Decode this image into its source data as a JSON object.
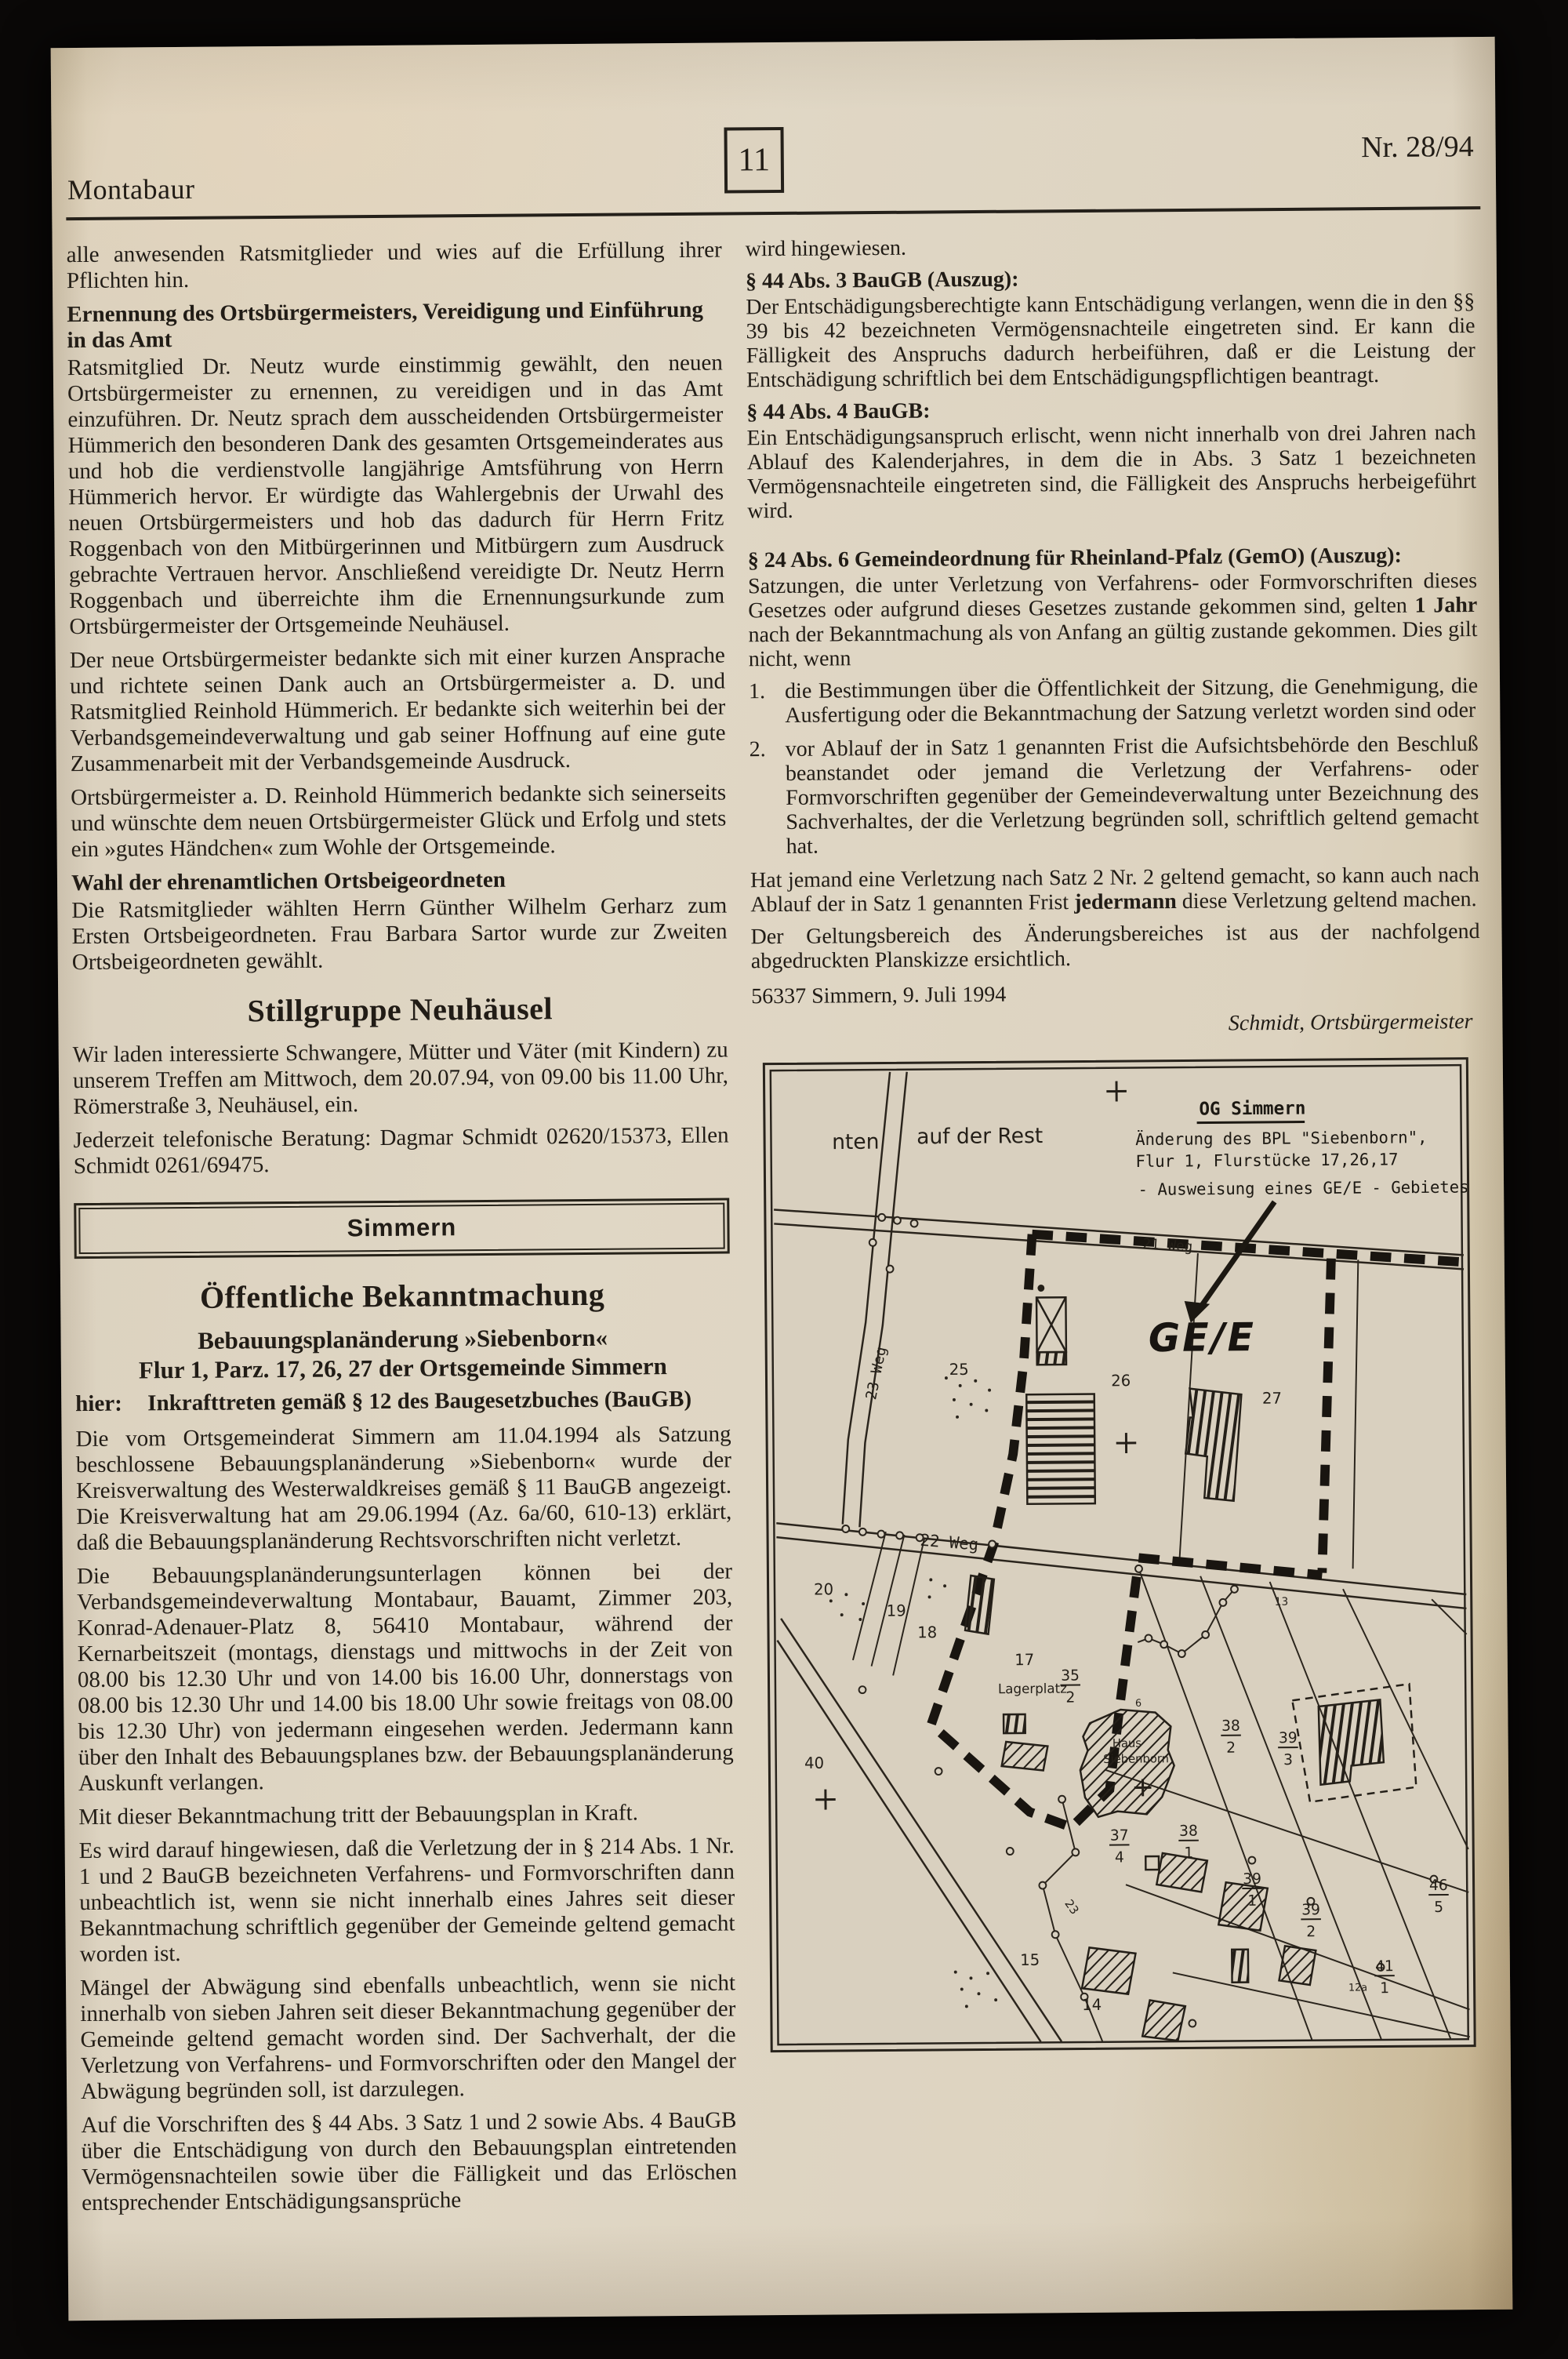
{
  "colors": {
    "paper": "#ddd3c0",
    "ink": "#211c16",
    "background": "#0a0807"
  },
  "header": {
    "title_left": "Montabaur",
    "page_number": "11",
    "issue": "Nr. 28/94"
  },
  "left": {
    "p1": "alle anwesenden Ratsmitglieder und wies auf die Erfüllung ihrer Pflichten hin.",
    "h1": "Ernennung des Ortsbürgermeisters, Vereidigung und Einführung in das Amt",
    "p2": "Ratsmitglied Dr. Neutz wurde einstimmig gewählt, den neuen Ortsbürgermeister zu ernennen, zu vereidigen und in das Amt einzuführen. Dr. Neutz sprach dem ausscheidenden Ortsbürgermeister Hümmerich den besonderen Dank des gesamten Ortsgemeinderates aus und hob die verdienstvolle langjährige Amtsführung von Herrn Hümmerich hervor. Er würdigte das Wahlergebnis der Urwahl des neuen Ortsbürgermeisters und hob das dadurch für Herrn Fritz Roggenbach von den Mitbürgerinnen und Mitbürgern zum Ausdruck gebrachte Vertrauen hervor. Anschließend vereidigte Dr. Neutz Herrn Roggenbach und überreichte ihm die Ernennungsurkunde zum Ortsbürgermeister der Ortsgemeinde Neuhäusel.",
    "p3": "Der neue Ortsbürgermeister bedankte sich mit einer kurzen Ansprache und richtete seinen Dank auch an Ortsbürgermeister a. D. und Ratsmitglied Reinhold Hümmerich. Er bedankte sich weiterhin bei der Verbandsgemeindeverwaltung und gab seiner Hoffnung auf eine gute Zusammenarbeit mit der Verbandsgemeinde Ausdruck.",
    "p4": "Ortsbürgermeister a. D. Reinhold Hümmerich bedankte sich seinerseits und wünschte dem neuen Ortsbürgermeister Glück und Erfolg und stets ein »gutes Händchen« zum Wohle der Ortsgemeinde.",
    "h2": "Wahl der ehrenamtlichen Ortsbeigeordneten",
    "p5": "Die Ratsmitglieder wählten Herrn Günther Wilhelm Gerharz zum Ersten Ortsbeigeordneten. Frau Barbara Sartor wurde zur Zweiten Ortsbeigeordneten gewählt.",
    "headline1": "Stillgruppe Neuhäusel",
    "p6": "Wir laden interessierte Schwangere, Mütter und Väter (mit Kindern) zu unserem Treffen am Mittwoch, dem 20.07.94, von 09.00 bis 11.00 Uhr, Römerstraße 3, Neuhäusel, ein.",
    "p7": "Jederzeit telefonische Beratung: Dagmar Schmidt 02620/15373, Ellen Schmidt 0261/69475.",
    "box_label": "Simmern",
    "headline2": "Öffentliche Bekanntmachung",
    "sub1": "Bebauungsplanänderung »Siebenborn«",
    "sub2": "Flur 1, Parz. 17, 26, 27 der Ortsgemeinde Simmern",
    "hier_label": "hier:",
    "hier_text": "Inkrafttreten gemäß § 12 des Baugesetzbuches (BauGB)",
    "p8": "Die vom Ortsgemeinderat Simmern am 11.04.1994 als Satzung beschlossene Bebauungsplanänderung »Siebenborn« wurde der Kreisverwaltung des Westerwaldkreises gemäß § 11 BauGB angezeigt. Die Kreisverwaltung hat am 29.06.1994 (Az. 6a/60, 610-13) erklärt, daß die Bebauungsplanänderung Rechtsvorschriften nicht verletzt.",
    "p9": "Die Bebauungsplanänderungsunterlagen können bei der Verbandsgemeindeverwaltung Montabaur, Bauamt, Zimmer 203, Konrad-Adenauer-Platz 8, 56410 Montabaur, während der Kernarbeitszeit (montags, dienstags und mittwochs in der Zeit von 08.00 bis 12.30 Uhr und von 14.00 bis 16.00 Uhr, donnerstags von 08.00 bis 12.30 Uhr und 14.00 bis 18.00 Uhr sowie freitags von 08.00 bis 12.30 Uhr) von jedermann eingesehen werden. Jedermann kann über den Inhalt des Bebauungsplanes bzw. der Bebauungsplanänderung Auskunft verlangen.",
    "p10": "Mit dieser Bekanntmachung tritt der Bebauungsplan in Kraft.",
    "p11": "Es wird darauf hingewiesen, daß die Verletzung der in § 214 Abs. 1 Nr. 1 und 2 BauGB bezeichneten Verfahrens- und Formvorschriften dann unbeachtlich ist, wenn sie nicht innerhalb eines Jahres seit dieser Bekanntmachung schriftlich gegenüber der Gemeinde geltend gemacht worden ist.",
    "p12": "Mängel der Abwägung sind ebenfalls unbeachtlich, wenn sie nicht innerhalb von sieben Jahren seit dieser Bekanntmachung gegenüber der Gemeinde geltend gemacht worden sind. Der Sachverhalt, der die Verletzung von Verfahrens- und Formvorschriften oder den Mangel der Abwägung begründen soll, ist darzulegen.",
    "p13": "Auf die Vorschriften des § 44 Abs. 3 Satz 1 und 2 sowie Abs. 4 BauGB über die Entschädigung von durch den Bebauungsplan eintretenden Vermögensnachteilen sowie über die Fälligkeit und das Erlöschen entsprechender Entschädigungsansprüche"
  },
  "right": {
    "p1": "wird hingewiesen.",
    "h1": "§ 44 Abs. 3 BauGB (Auszug):",
    "p2": "Der Entschädigungsberechtigte kann Entschädigung verlangen, wenn die in den §§ 39 bis 42 bezeichneten Vermögensnachteile eingetreten sind. Er kann die Fälligkeit des Anspruchs dadurch herbeiführen, daß er die Leistung der Entschädigung schriftlich bei dem Entschädigungspflichtigen beantragt.",
    "h2": "§ 44 Abs. 4 BauGB:",
    "p3": "Ein Entschädigungsanspruch erlischt, wenn nicht innerhalb von drei Jahren nach Ablauf des Kalenderjahres, in dem die in Abs. 3 Satz 1 bezeichneten Vermögensnachteile eingetreten sind, die Fälligkeit des Anspruchs herbeigeführt wird.",
    "h3": "§ 24 Abs. 6 Gemeindeordnung für Rheinland-Pfalz (GemO) (Auszug):",
    "p4a": "Satzungen, die unter Verletzung von Verfahrens- oder Formvorschriften dieses Gesetzes oder aufgrund dieses Gesetzes zustande gekommen sind, gelten ",
    "p4b": "1 Jahr",
    "p4c": " nach der Bekanntmachung als von Anfang an gültig zustande gekommen. Dies gilt nicht, wenn",
    "li1_num": "1.",
    "li1": "die Bestimmungen über die Öffentlichkeit der Sitzung, die Genehmigung, die Ausfertigung oder die Bekanntmachung der Satzung verletzt worden sind oder",
    "li2_num": "2.",
    "li2": "vor Ablauf der in Satz 1 genannten Frist die Aufsichtsbehörde den Beschluß beanstandet oder jemand die Verletzung der Verfahrens- oder Formvorschriften gegenüber der Gemeindeverwaltung unter Bezeichnung des Sachverhaltes, der die Verletzung begründen soll, schriftlich geltend gemacht hat.",
    "p5a": "Hat jemand eine Verletzung nach Satz 2 Nr. 2 geltend gemacht, so kann auch nach Ablauf der in Satz 1 genannten Frist ",
    "p5b": "jedermann",
    "p5c": " diese Verletzung geltend machen.",
    "p6": "Der Geltungsbereich des Änderungsbereiches ist aus der nachfolgend abgedruckten Planskizze ersichtlich.",
    "dateline": "56337 Simmern, 9. Juli 1994",
    "signature": "Schmidt, Ortsbürgermeister"
  },
  "map": {
    "title": "OG Simmern",
    "line1": "Änderung des BPL \"Siebenborn\",",
    "line2": "Flur 1, Flurstücke 17,26,17",
    "line3": "- Ausweisung eines GE/E - Gebietes -",
    "area": "GE/E",
    "lbl_nten": "nten",
    "lbl_rest": "auf der Rest",
    "weg21": "21 Weg",
    "weg22": "22 Weg",
    "weg23": "23 Weg",
    "road23": "23",
    "lagerplatz": "Lagerplatz",
    "haus1": "Haus",
    "haus2": "Siebenborn",
    "parcels": {
      "p25": "25",
      "p26": "26",
      "p27": "27",
      "p20": "20",
      "p19": "19",
      "p18": "18",
      "p17": "17",
      "p15": "15",
      "p14": "14",
      "p40": "40",
      "p13": "13",
      "p6": "6",
      "p12a": "12a"
    },
    "fractions": {
      "f35": {
        "n": "35",
        "d": "2"
      },
      "f37": {
        "n": "37",
        "d": "4"
      },
      "f38a": {
        "n": "38",
        "d": "1"
      },
      "f38b": {
        "n": "38",
        "d": "2"
      },
      "f39a": {
        "n": "39",
        "d": "1"
      },
      "f39b": {
        "n": "39",
        "d": "2"
      },
      "f39c": {
        "n": "39",
        "d": "3"
      },
      "f41": {
        "n": "41",
        "d": "1"
      },
      "f46": {
        "n": "46",
        "d": "5"
      }
    }
  }
}
